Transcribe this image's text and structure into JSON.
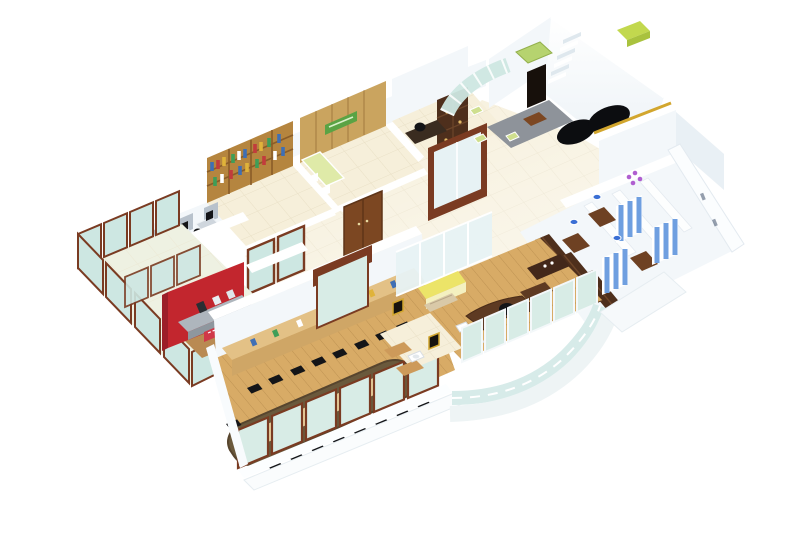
{
  "meta": {
    "title": "3D isometric office floor plan render",
    "canvas": {
      "width": 800,
      "height": 550
    }
  },
  "palette": {
    "white": "#ffffff",
    "wallShade": "#f3f7fa",
    "wallShade2": "#e9f0f5",
    "wallEdge": "#dde6ec",
    "floorTile": "#f6efda",
    "floorTileLine": "#e9e0c6",
    "floorSheen": "#fffdf4",
    "terraceFloor": "#eef1e2",
    "woodFloor": "#d8ab66",
    "woodFloorLine": "#b8894a",
    "woodLight": "#caa45f",
    "woodMid": "#b5853f",
    "woodDark": "#4e2f1c",
    "woodDeep": "#7c4722",
    "frameBrown": "#7a3b22",
    "glassTeal": "#cde7e2",
    "glassTeal2": "#d8ece6",
    "glassPale": "#e7f2f4",
    "green": "#b6d36f",
    "greenSign": "#5aa344",
    "lime": "#c2d84e",
    "greenCounter": "#dfeaa8",
    "greenChair": "#cfdf8e",
    "greenDispenser": "#86c94e",
    "red": "#c2262e",
    "redBanner": "#d03848",
    "steel": "#aeb6bd",
    "steelDark": "#8e979e",
    "rug": "#8e939a",
    "black": "#141518",
    "yellow": "#ece468",
    "blueTile": "#6f9fe0",
    "blueSink": "#3b6fd4",
    "purple": "#b05fd0",
    "gold": "#d2a62e",
    "tableDark": "#6a593c",
    "tableInlay": "#ecd3a0",
    "credenzaTop": "#e3c186",
    "credenzaFace": "#cfa666",
    "partition": "#b8c2cc",
    "deskGray": "#cfd6dd",
    "bookBlue": "#3f6fb5",
    "bookRed": "#c23c3c",
    "bookYellow": "#e0b33a",
    "bookGreen": "#3f9e58"
  },
  "scene": {
    "view": "isometric-cutaway",
    "background": "#ffffff",
    "rooms": [
      {
        "id": "open-workstations",
        "features": [
          "three-desks",
          "gray-partitions",
          "black-monitors",
          "black-chairs"
        ]
      },
      {
        "id": "library",
        "features": [
          "wood-bookshelf-wall",
          "multicolor-books",
          "brown-framed-glass-doors"
        ]
      },
      {
        "id": "pantry",
        "features": [
          "wood-panel-wall",
          "green-signboard",
          "green-counter",
          "wood-double-door"
        ]
      },
      {
        "id": "manager-cabin",
        "features": [
          "dark-wood-cabinet",
          "desk",
          "black-chair",
          "brown-framed-glass-slider"
        ]
      },
      {
        "id": "stair-lift-core",
        "features": [
          "white-staircase",
          "green-lift-cab",
          "dark-doorway",
          "lime-planter"
        ]
      },
      {
        "id": "entry-lounge",
        "features": [
          "curved-glass-wall",
          "gray-rug",
          "green-armchairs",
          "wood-coffee-table",
          "black-curved-sofa",
          "gold-wall-trim"
        ]
      },
      {
        "id": "glass-terrace",
        "features": [
          "teal-glass-panels",
          "brown-frames"
        ]
      },
      {
        "id": "kitchenette",
        "features": [
          "red-accent-wall",
          "steel-counter",
          "red-menu-strip",
          "green-water-dispenser"
        ]
      },
      {
        "id": "conference-room",
        "features": [
          "long-dark-table",
          "light-wood-inlay",
          "black-chairs",
          "wood-credenza",
          "brown-framed-window-band"
        ]
      },
      {
        "id": "executive-office",
        "features": [
          "wood-floor",
          "glass-partition",
          "yellow-sofa",
          "curved-executive-desk",
          "black-chair",
          "white-guest-chairs",
          "dark-credenza"
        ]
      },
      {
        "id": "washroom-anteroom",
        "features": [
          "white-basin",
          "wood-benches",
          "gold-framed-pictures",
          "brown-framed-glass-slider"
        ]
      },
      {
        "id": "storage-room",
        "features": [
          "dark-cabinet-rows",
          "corner-desk"
        ]
      },
      {
        "id": "washrooms",
        "features": [
          "blue-tiled-stalls",
          "wood-stall-floors",
          "blue-basins",
          "purple-flowers"
        ]
      },
      {
        "id": "exterior",
        "features": [
          "curved-glass-atrium",
          "white-balcony-ledges",
          "cream-glossy-tiles"
        ]
      }
    ]
  }
}
